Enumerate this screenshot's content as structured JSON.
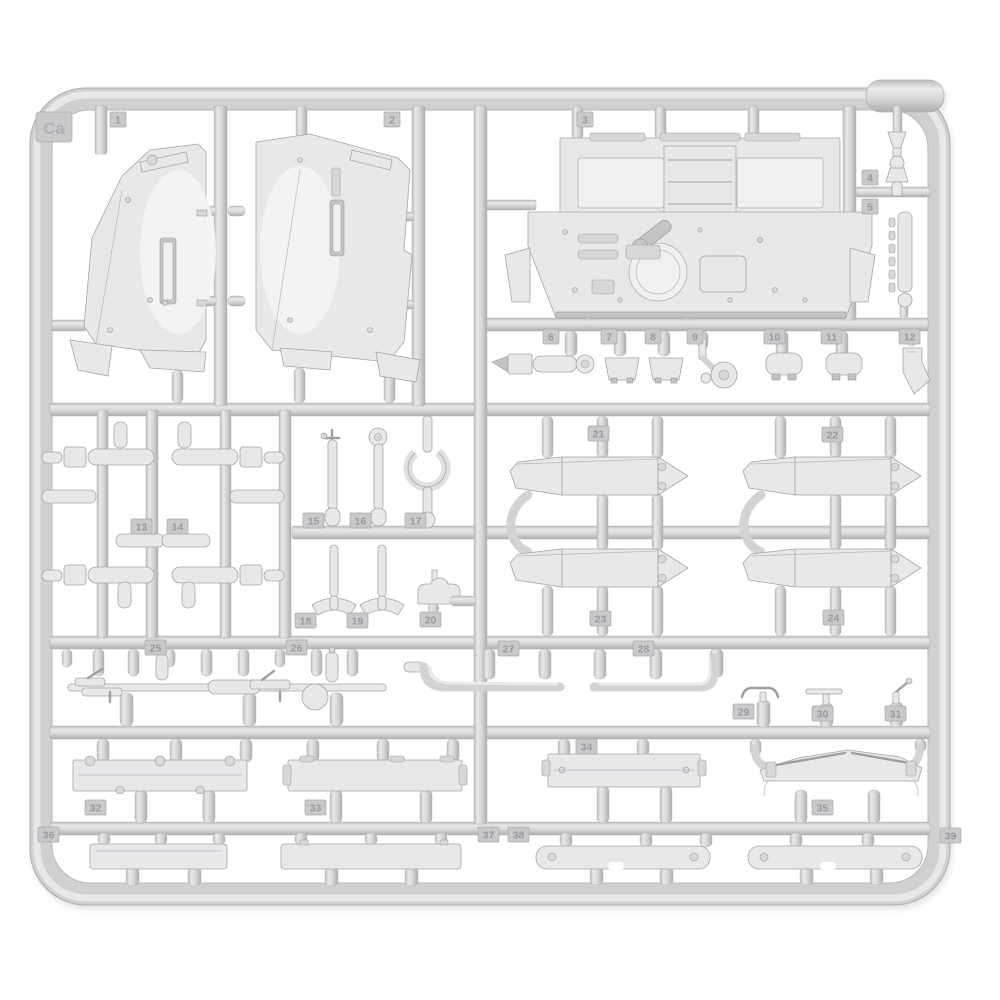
{
  "meta": {
    "subject": "Injection-molded light gray plastic model kit sprue (runner frame) with numbered armored-vehicle parts",
    "background_color": "#ffffff",
    "plastic_color": "#d4d5d7",
    "plastic_highlight": "#eceded",
    "plastic_shadow": "#aeafb1",
    "tag_color": "#c8c9cb"
  },
  "sprue": {
    "corner_label": "Ca",
    "part_tags": [
      {
        "label": "1",
        "x": 110,
        "y": 112
      },
      {
        "label": "2",
        "x": 384,
        "y": 112
      },
      {
        "label": "3",
        "x": 577,
        "y": 112
      },
      {
        "label": "4",
        "x": 862,
        "y": 170
      },
      {
        "label": "5",
        "x": 862,
        "y": 199
      },
      {
        "label": "6",
        "x": 543,
        "y": 329
      },
      {
        "label": "7",
        "x": 601,
        "y": 329
      },
      {
        "label": "8",
        "x": 645,
        "y": 329
      },
      {
        "label": "9",
        "x": 687,
        "y": 329
      },
      {
        "label": "10",
        "x": 764,
        "y": 329
      },
      {
        "label": "11",
        "x": 821,
        "y": 329
      },
      {
        "label": "12",
        "x": 899,
        "y": 329
      },
      {
        "label": "13",
        "x": 131,
        "y": 519
      },
      {
        "label": "14",
        "x": 167,
        "y": 519
      },
      {
        "label": "15",
        "x": 303,
        "y": 513
      },
      {
        "label": "16",
        "x": 350,
        "y": 513
      },
      {
        "label": "17",
        "x": 405,
        "y": 513
      },
      {
        "label": "18",
        "x": 295,
        "y": 613
      },
      {
        "label": "19",
        "x": 347,
        "y": 613
      },
      {
        "label": "20",
        "x": 420,
        "y": 612
      },
      {
        "label": "21",
        "x": 588,
        "y": 426
      },
      {
        "label": "22",
        "x": 822,
        "y": 427
      },
      {
        "label": "23",
        "x": 590,
        "y": 611
      },
      {
        "label": "24",
        "x": 823,
        "y": 610
      },
      {
        "label": "25",
        "x": 145,
        "y": 640
      },
      {
        "label": "26",
        "x": 286,
        "y": 640
      },
      {
        "label": "27",
        "x": 498,
        "y": 641
      },
      {
        "label": "28",
        "x": 633,
        "y": 641
      },
      {
        "label": "29",
        "x": 733,
        "y": 704
      },
      {
        "label": "30",
        "x": 812,
        "y": 706
      },
      {
        "label": "31",
        "x": 885,
        "y": 706
      },
      {
        "label": "32",
        "x": 85,
        "y": 800
      },
      {
        "label": "33",
        "x": 305,
        "y": 800
      },
      {
        "label": "34",
        "x": 576,
        "y": 739
      },
      {
        "label": "35",
        "x": 812,
        "y": 800
      },
      {
        "label": "36",
        "x": 38,
        "y": 827
      },
      {
        "label": "37",
        "x": 478,
        "y": 827
      },
      {
        "label": "38",
        "x": 508,
        "y": 827
      },
      {
        "label": "39",
        "x": 940,
        "y": 828
      }
    ]
  }
}
